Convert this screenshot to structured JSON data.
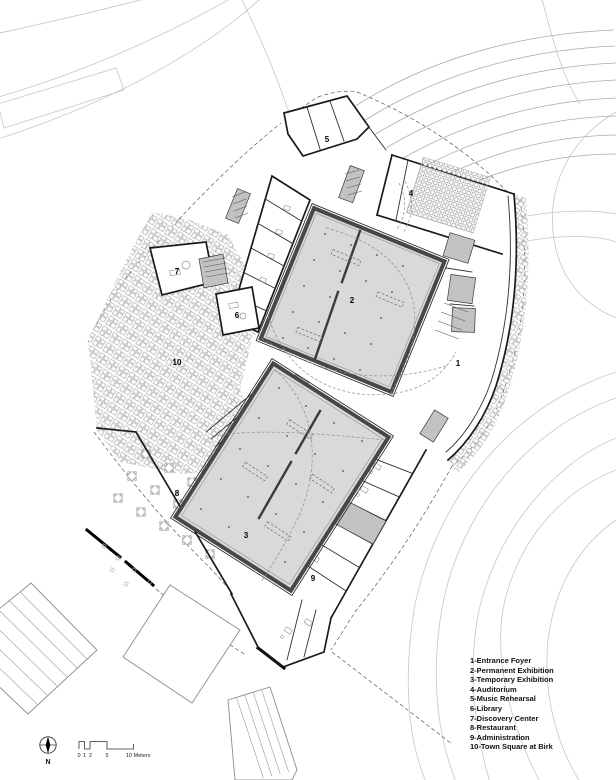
{
  "legend": {
    "items": [
      "1-Entrance Foyer",
      "2-Permanent Exhibition",
      "3-Temporary Exhibition",
      "4-Auditorium",
      "5-Music Rehearsal",
      "6-Library",
      "7-Discovery Center",
      "8-Restaurant",
      "9-Administration",
      "10-Town Square at Birk"
    ]
  },
  "room_labels": [
    "1",
    "2",
    "3",
    "4",
    "5",
    "6",
    "7",
    "8",
    "9",
    "10"
  ],
  "scale_bar": {
    "ticks": [
      "0",
      "1",
      "2",
      "5"
    ],
    "end_label": "10 Meters"
  },
  "north": {
    "label": "N"
  },
  "colors": {
    "hall_fill": "#d9d9d9",
    "hall_wall": "#474747",
    "wall": "#1a1a1a",
    "paving_line": "#9c9c9c",
    "road_line": "#c6c6c6",
    "terrace_line": "#ababab",
    "text": "#111111"
  }
}
